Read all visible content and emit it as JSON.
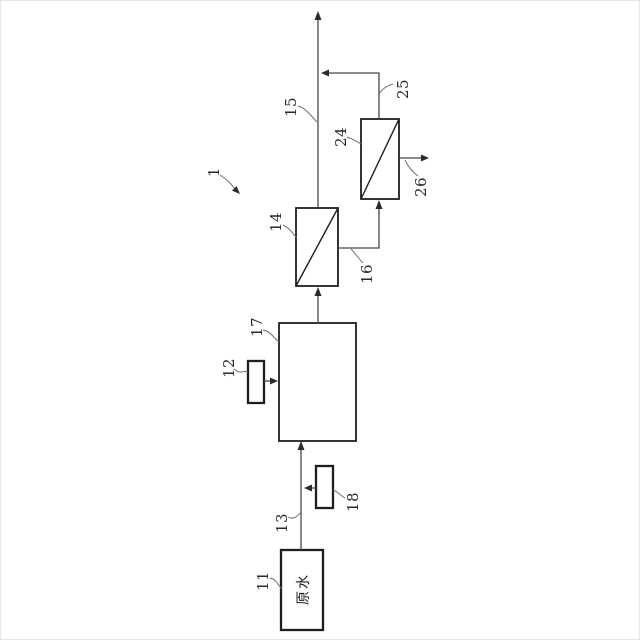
{
  "figure": {
    "refs": {
      "system": "1",
      "raw_water_tank": "11",
      "dosing_unit_12": "12",
      "feed_line": "13",
      "membrane_module_14": "14",
      "outlet_line_15": "15",
      "intermediate_line_16": "16",
      "treatment_tank_17": "17",
      "dosing_unit_18": "18",
      "membrane_module_24": "24",
      "return_line_25": "25",
      "discharge_line_26": "26"
    },
    "texts": {
      "raw_water": "原水"
    }
  }
}
